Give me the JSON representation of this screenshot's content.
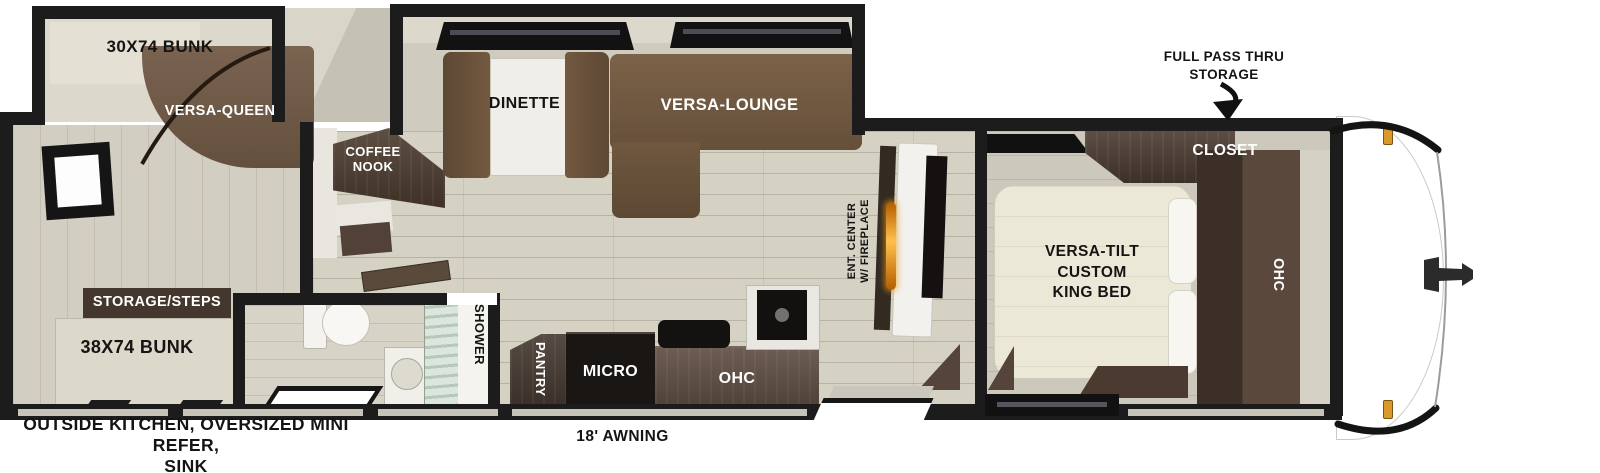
{
  "floorplan": {
    "rear": {
      "bunk_top": "30X74 BUNK",
      "sofa": "VERSA-QUEEN",
      "storage_steps": "STORAGE/STEPS",
      "bunk_bottom": "38X74 BUNK"
    },
    "living": {
      "coffee_nook": "COFFEE\nNOOK",
      "dinette": "DINETTE",
      "lounge": "VERSA-LOUNGE",
      "ent_center": "ENT. CENTER\nW/ FIREPLACE"
    },
    "bath": {
      "shower": "SHOWER"
    },
    "kitchen": {
      "pantry": "PANTRY",
      "micro": "MICRO",
      "ohc": "OHC"
    },
    "bedroom": {
      "bed": "VERSA-TILT\nCUSTOM\nKING BED",
      "closet": "CLOSET",
      "ohc": "OHC"
    },
    "annotations": {
      "pass_thru": "FULL PASS THRU\nSTORAGE",
      "outside_features": "OUTSIDE KITCHEN, OVERSIZED MINI REFER,\nSINK",
      "awning": "18' AWNING"
    },
    "colors": {
      "wall": "#1c1c1c",
      "cabinet_dark": "#44372e",
      "sofa_brown": "#6d5541",
      "floor_wood": "#d5d1c3",
      "bed_cream": "#ece8d7",
      "fireplace_amber": "#f09c1a",
      "clearance_marker": "#d99a2b"
    }
  }
}
